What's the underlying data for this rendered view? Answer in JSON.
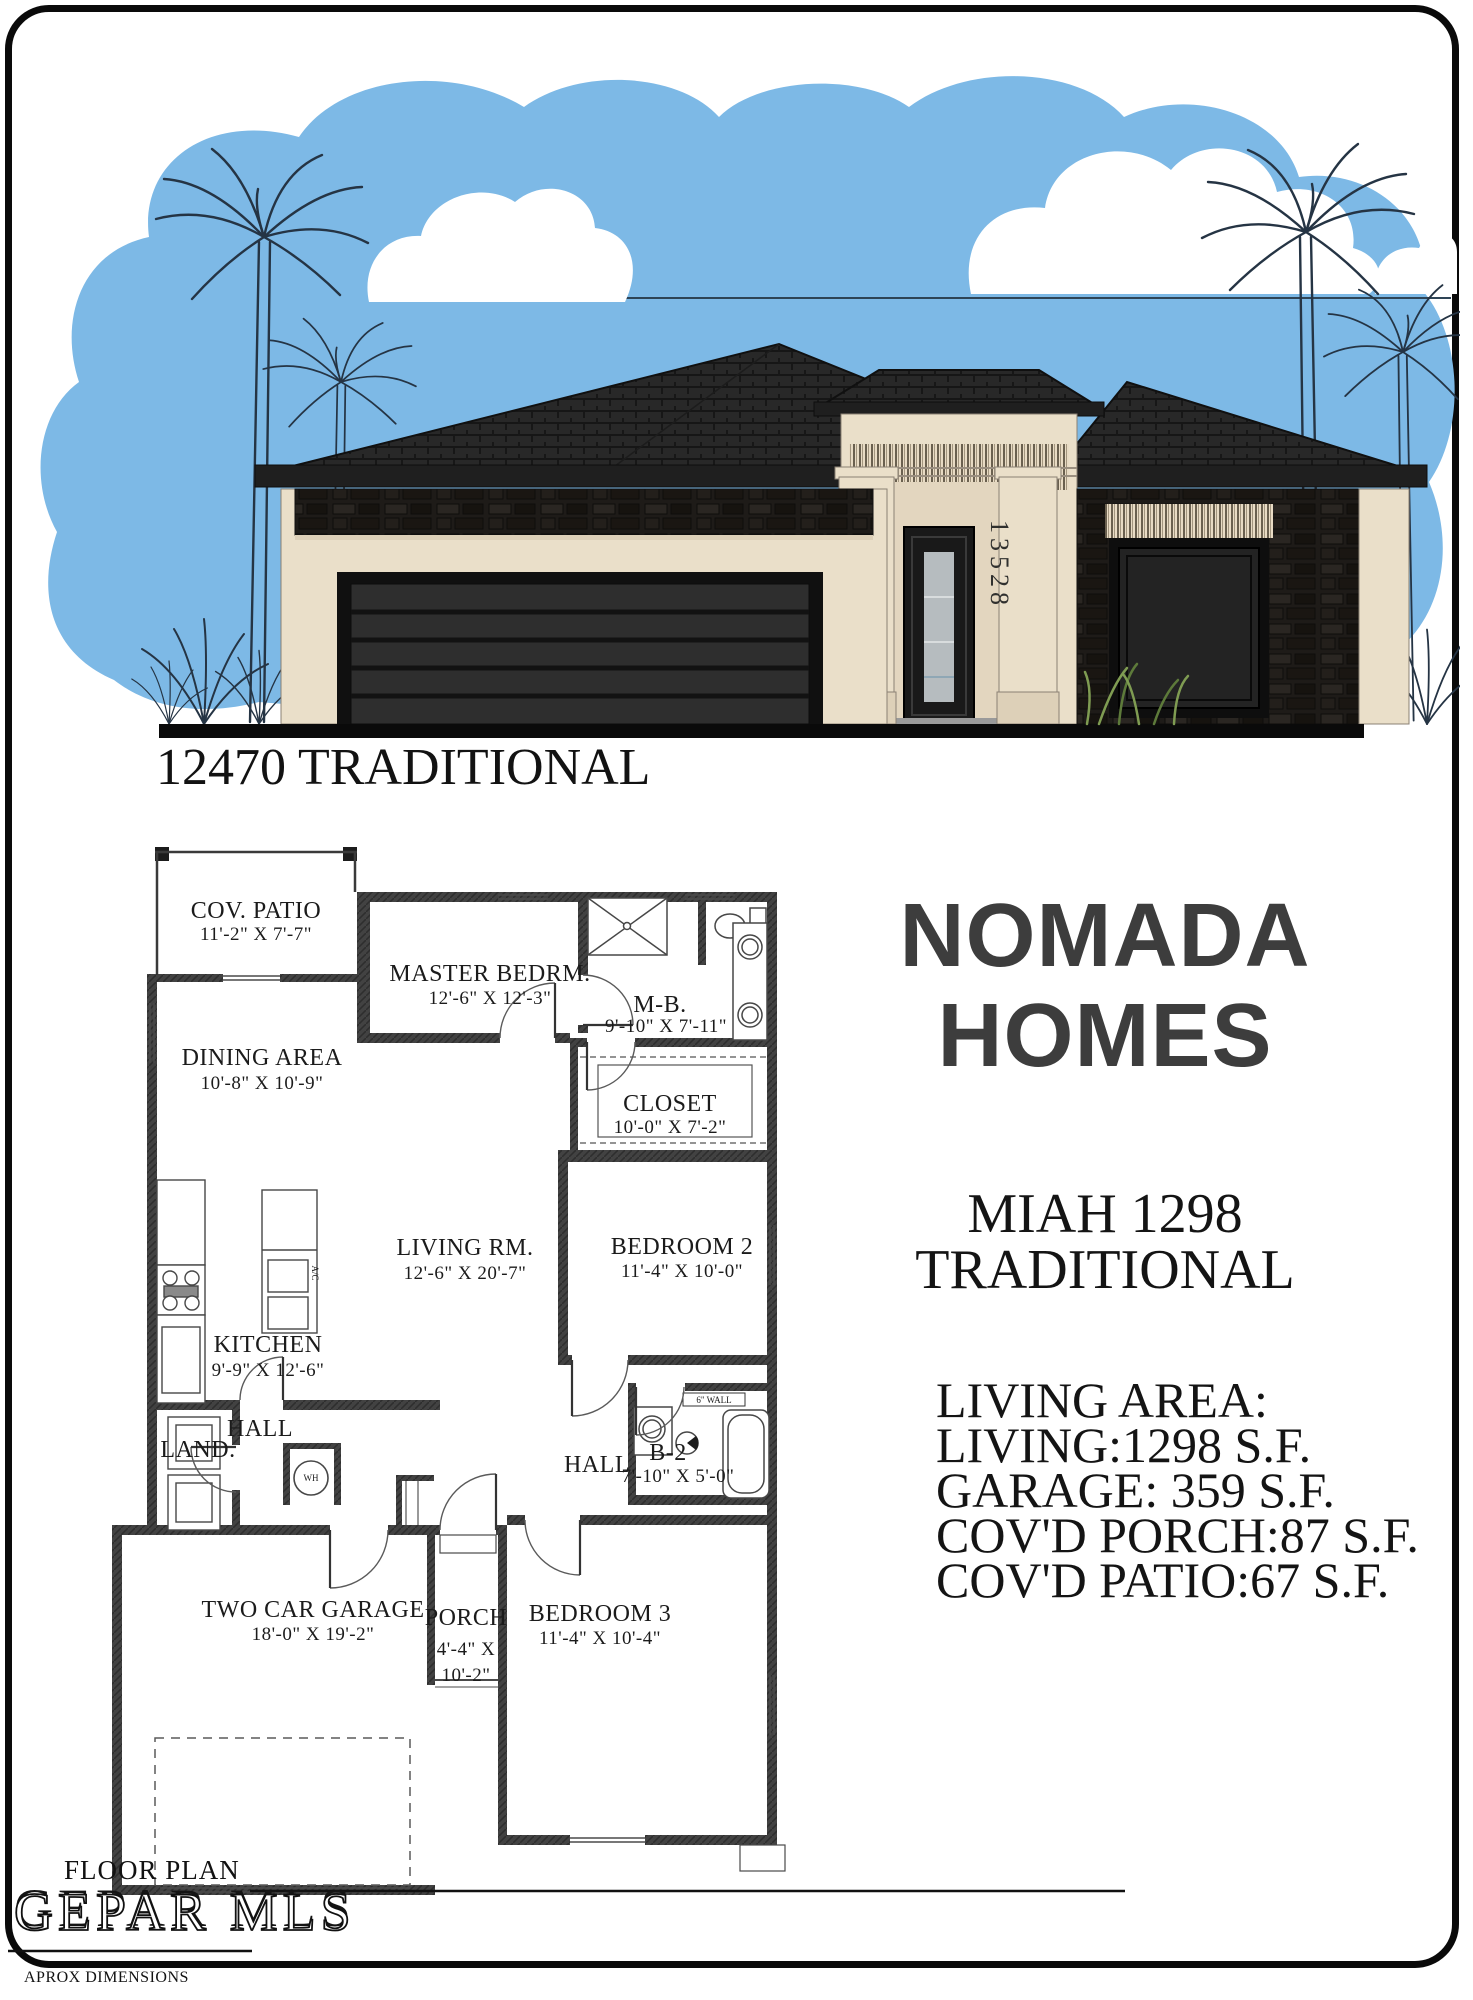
{
  "page": {
    "title": "12470 TRADITIONAL"
  },
  "elevation": {
    "house_number": "13528"
  },
  "plan": {
    "rooms": [
      {
        "name": "COV. PATIO",
        "dims": "11'-2\" X 7'-7\""
      },
      {
        "name": "MASTER BEDRM.",
        "dims": "12'-6\" X 12'-3\""
      },
      {
        "name": "M-B.",
        "dims": "9'-10\" X 7'-11\""
      },
      {
        "name": "CLOSET",
        "dims": "10'-0\" X 7'-2\""
      },
      {
        "name": "DINING AREA",
        "dims": "10'-8\" X 10'-9\""
      },
      {
        "name": "LIVING RM.",
        "dims": "12'-6\" X 20'-7\""
      },
      {
        "name": "BEDROOM 2",
        "dims": "11'-4\" X 10'-0\""
      },
      {
        "name": "KITCHEN",
        "dims": "9'-9\" X 12'-6\""
      },
      {
        "name": "HALL"
      },
      {
        "name": "LAND."
      },
      {
        "name": "HALL"
      },
      {
        "name": "B-2",
        "dims": "7'-10\" X 5'-0\""
      },
      {
        "name": "TWO CAR GARAGE",
        "dims": "18'-0\" X 19'-2\""
      },
      {
        "name": "PORCH",
        "dims_line1": "4'-4\" X",
        "dims_line2": "10'-2\""
      },
      {
        "name": "BEDROOM 3",
        "dims": "11'-4\" X 10'-4\""
      }
    ],
    "annotations": {
      "water_heater": "WH",
      "wall_note": "6\"  WALL",
      "ac": "A/C"
    }
  },
  "sidebar": {
    "brand_line1": "NOMADA",
    "brand_line2": "HOMES",
    "model_line1": "MIAH 1298",
    "model_line2": "TRADITIONAL",
    "areas_title": "LIVING AREA:",
    "areas": [
      "LIVING:1298 S.F.",
      "GARAGE: 359 S.F.",
      "COV'D PORCH:87 S.F.",
      "COV'D PATIO:67 S.F."
    ]
  },
  "footer": {
    "plan_label": "FLOOR PLAN",
    "watermark": "GEPAR MLS",
    "disclaimer": "APROX DIMENSIONS"
  },
  "colors": {
    "sky": "#7db9e6",
    "stucco": "#eadfc9",
    "stucco_shade": "#ddd0b8",
    "roof": "#262626",
    "accent_dark": "#1d1b19",
    "brand_text": "#3d3d3d",
    "ink": "#121212"
  }
}
